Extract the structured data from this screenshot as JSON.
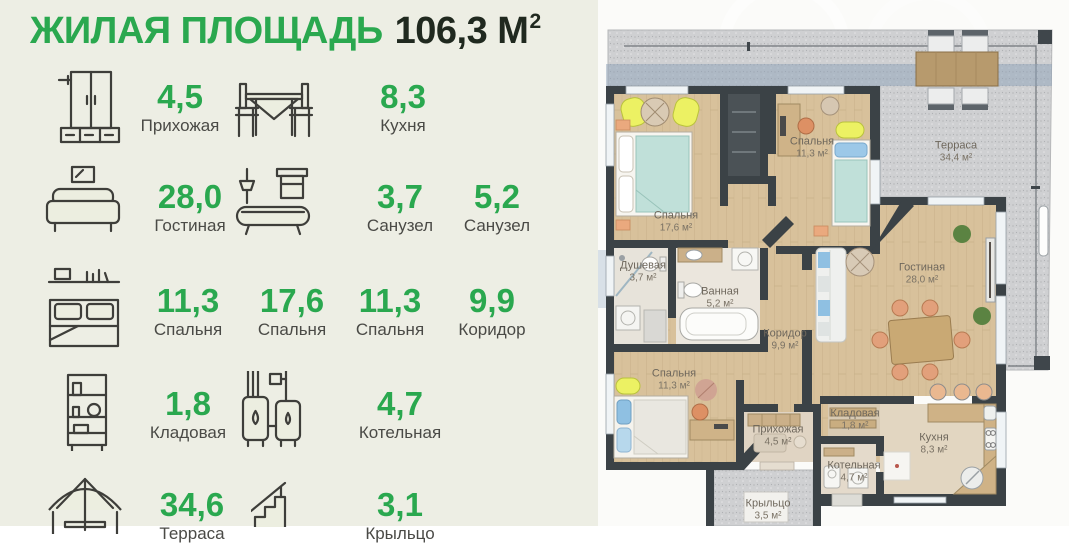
{
  "header": {
    "title": "ЖИЛАЯ ПЛОЩАДЬ",
    "total_value": "106,3",
    "total_unit": "М",
    "total_unit_sup": "2"
  },
  "legend": {
    "items": [
      {
        "icon": "wardrobe-icon",
        "value": "4,5",
        "label": "Прихожая"
      },
      {
        "icon": "kitchen-table-icon",
        "value": "8,3",
        "label": "Кухня"
      },
      {
        "icon": "sofa-icon",
        "value": "28,0",
        "label": "Гостиная"
      },
      {
        "icon": "bathtub-icon",
        "value": "3,7",
        "label": "Санузел"
      },
      {
        "icon": "",
        "value": "5,2",
        "label": "Санузел"
      },
      {
        "icon": "bed-icon",
        "value": "11,3",
        "label": "Спальня"
      },
      {
        "icon": "",
        "value": "17,6",
        "label": "Спальня"
      },
      {
        "icon": "",
        "value": "11,3",
        "label": "Спальня"
      },
      {
        "icon": "",
        "value": "9,9",
        "label": "Коридор"
      },
      {
        "icon": "shelf-icon",
        "value": "1,8",
        "label": "Кладовая"
      },
      {
        "icon": "boiler-icon",
        "value": "4,7",
        "label": "Котельная"
      },
      {
        "icon": "umbrella-icon",
        "value": "34,6",
        "label": "Терраса"
      },
      {
        "icon": "stairs-icon",
        "value": "3,1",
        "label": "Крыльцо"
      }
    ]
  },
  "plan": {
    "rooms": [
      {
        "name": "Спальня",
        "area": "17,6 м²"
      },
      {
        "name": "Спальня",
        "area": "11,3 м²"
      },
      {
        "name": "Терраса",
        "area": "34,4 м²"
      },
      {
        "name": "Душевая",
        "area": "3,7 м²"
      },
      {
        "name": "Ванная",
        "area": "5,2 м²"
      },
      {
        "name": "Коридор",
        "area": "9,9 м²"
      },
      {
        "name": "Гостиная",
        "area": "28,0 м²"
      },
      {
        "name": "Спальня",
        "area": "11,3 м²"
      },
      {
        "name": "Прихожая",
        "area": "4,5 м²"
      },
      {
        "name": "Кладовая",
        "area": "1,8 м²"
      },
      {
        "name": "Кухня",
        "area": "8,3 м²"
      },
      {
        "name": "Котельная",
        "area": "4,7 м²"
      },
      {
        "name": "Крыльцо",
        "area": "3,5 м²"
      }
    ]
  },
  "colors": {
    "accent_green": "#2aa84f",
    "wall_dark": "#3b4246",
    "legend_bg": "#edeee4",
    "floor_wood": "#d8c19a",
    "terrace_gray": "#cfd0d2",
    "furniture_yellow": "#ecf163"
  }
}
